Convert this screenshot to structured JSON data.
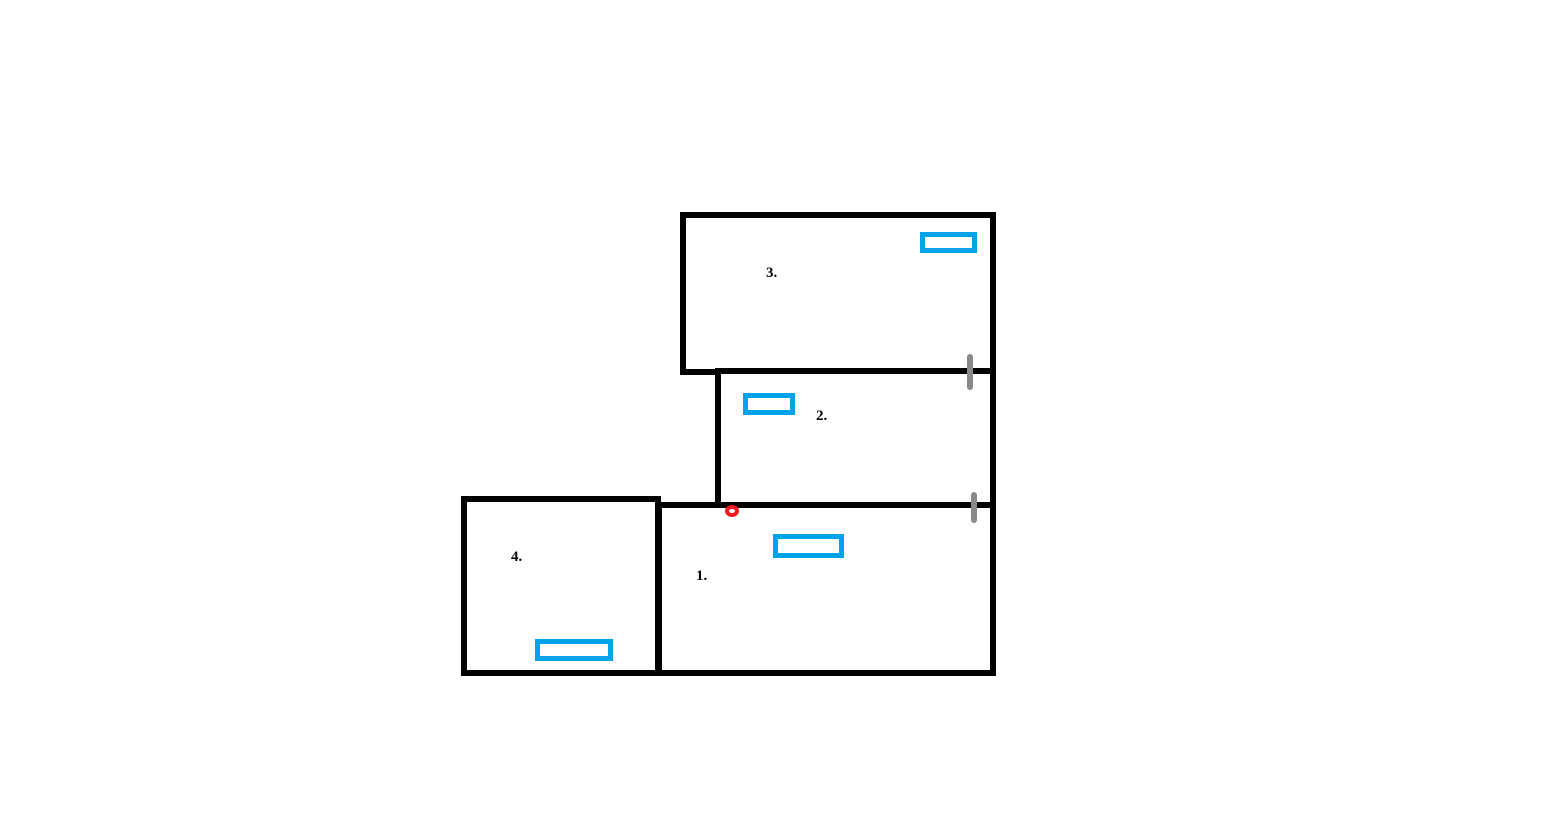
{
  "colors": {
    "background": "#ffffff",
    "wall": "#000000",
    "window": "#00a2e8",
    "door": "#8a8a8a",
    "marker": "#ed1c24"
  },
  "rooms": [
    {
      "label": "1."
    },
    {
      "label": "2."
    },
    {
      "label": "3."
    },
    {
      "label": "4."
    }
  ],
  "icons": {
    "windows": [
      "room-1-window-icon",
      "room-2-window-icon",
      "room-3-window-icon",
      "room-4-window-icon"
    ],
    "doors": [
      "door-dash-upper-icon",
      "door-dash-lower-icon"
    ],
    "point": "red-point-marker-icon"
  }
}
